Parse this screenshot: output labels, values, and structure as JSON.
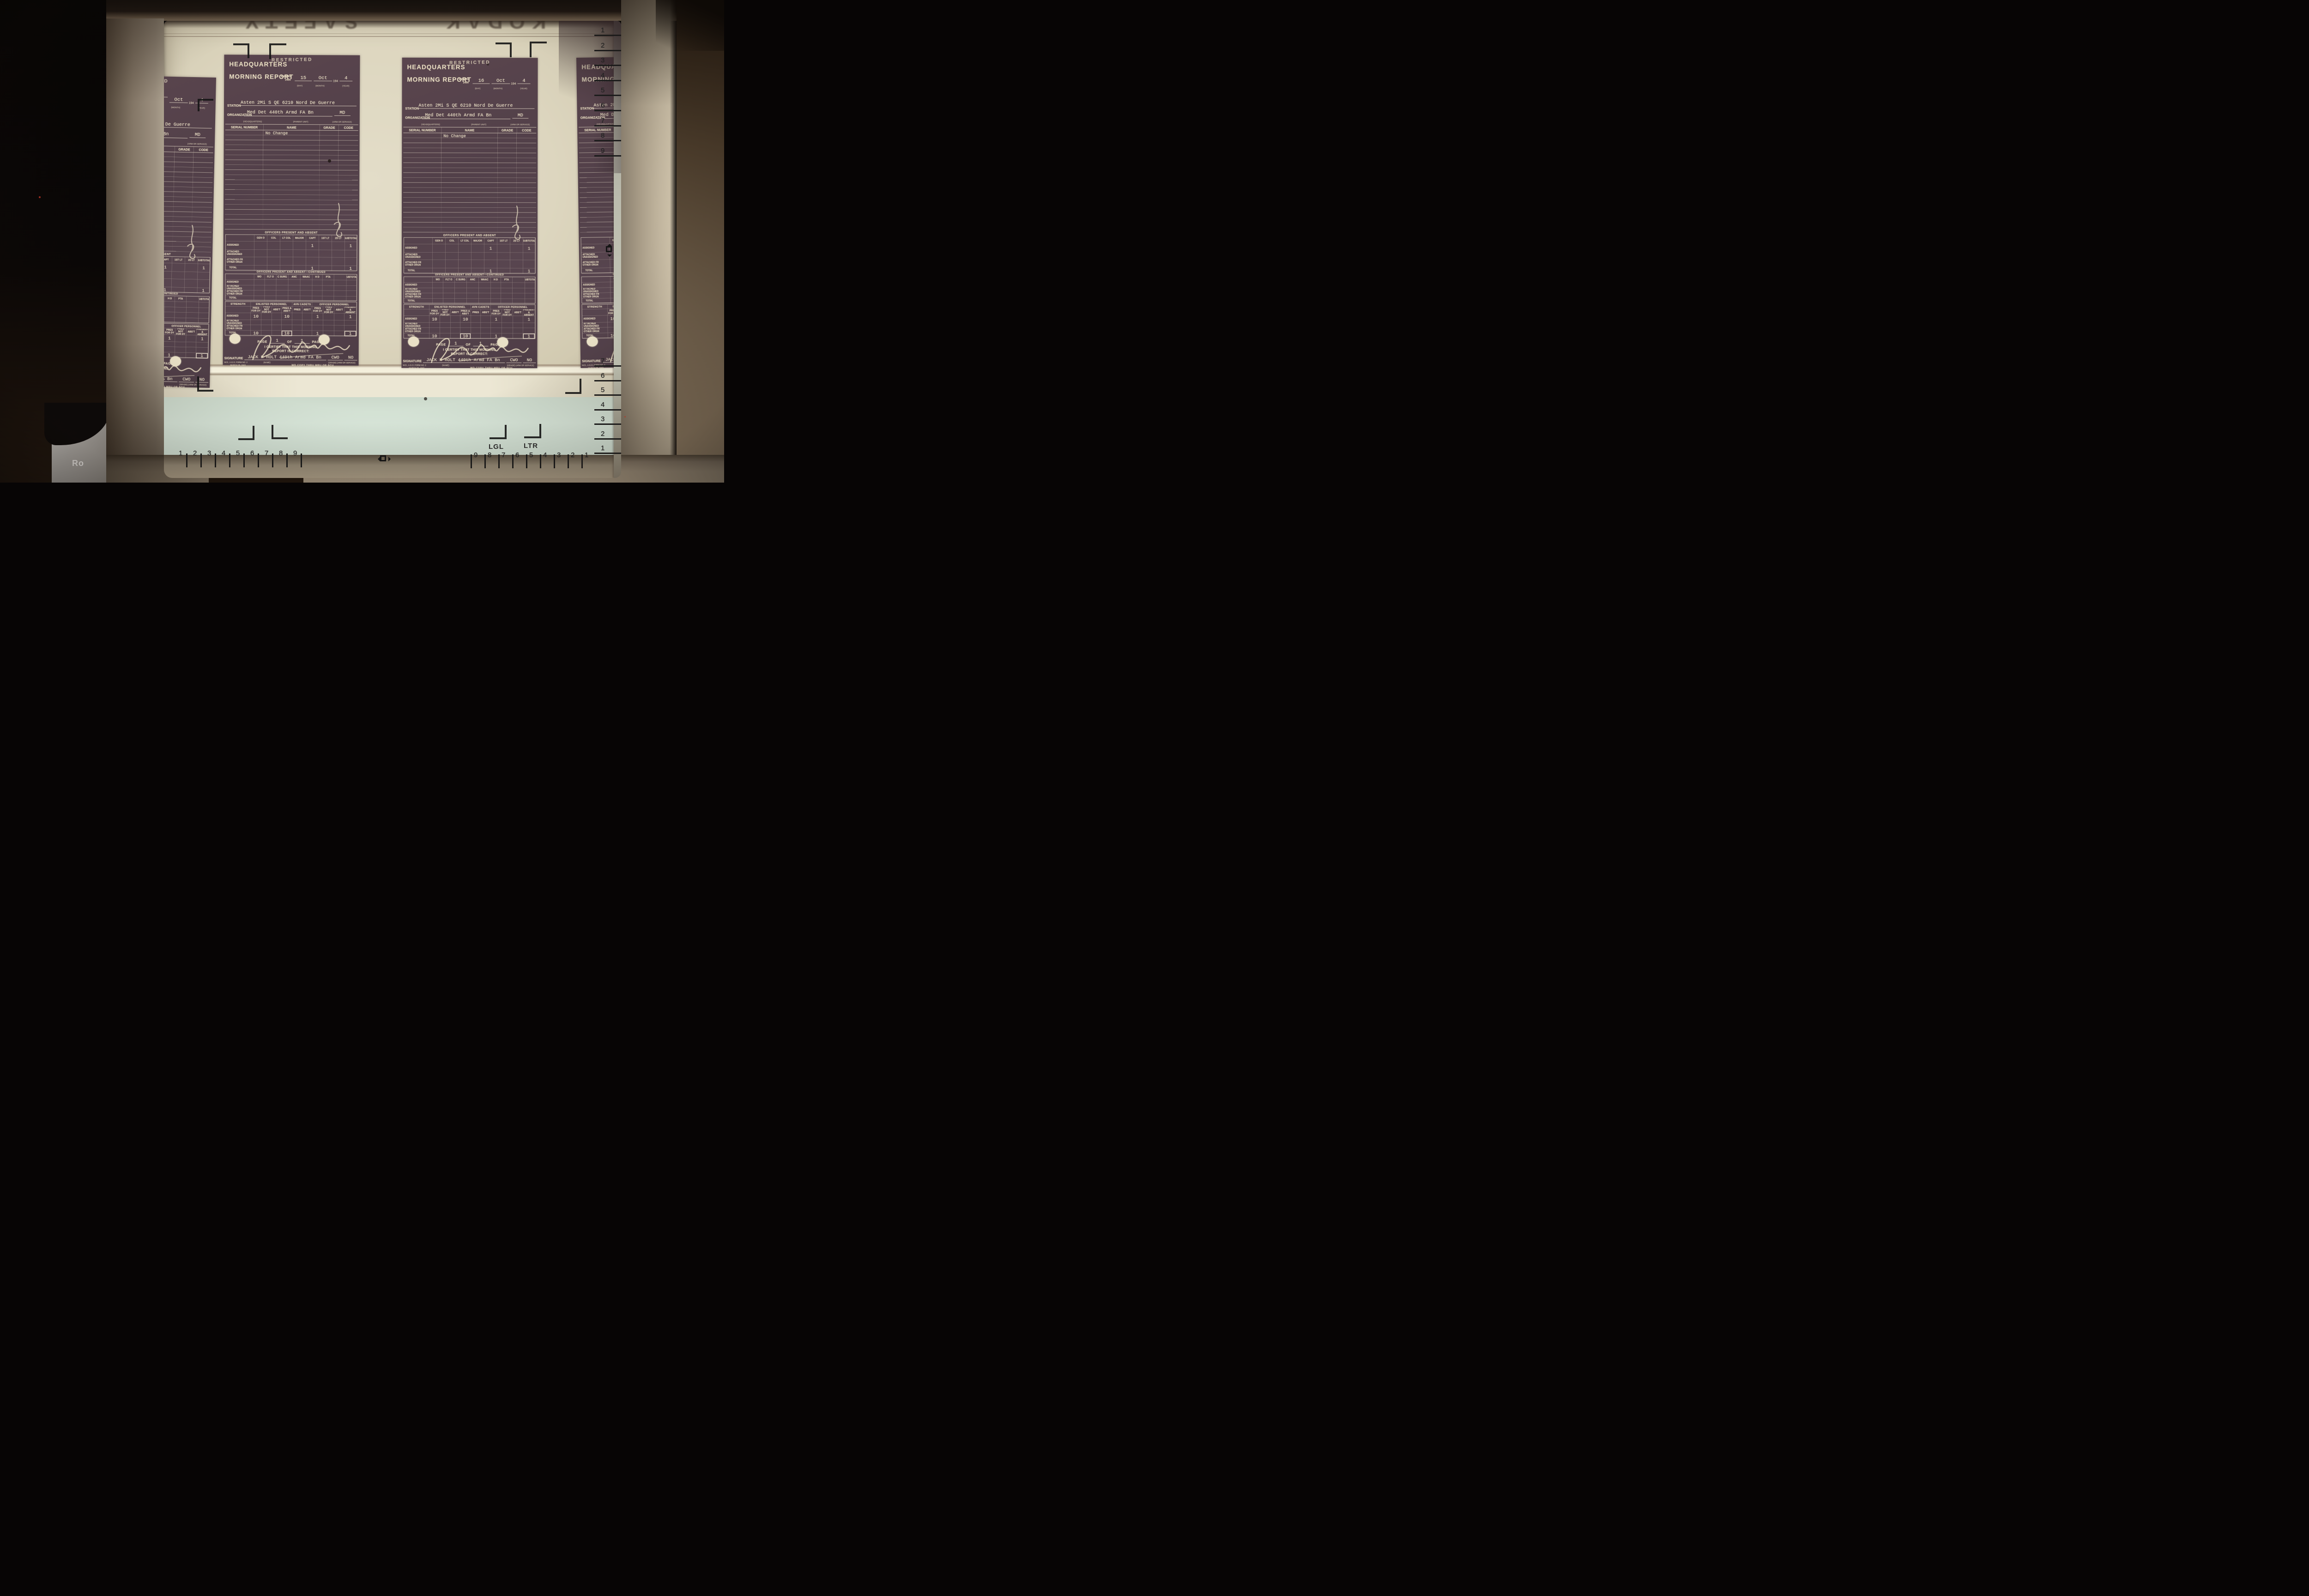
{
  "photo": {
    "device_brand_fragment": "Ro",
    "film_edge_text": "KODAK SAFETY"
  },
  "screen_controls": {
    "paper_size_left": "LGL",
    "paper_size_right": "LTR",
    "ruler_right_top": [
      "1",
      "2",
      "3",
      "4",
      "5",
      "6",
      "7",
      "8",
      "9"
    ],
    "ruler_right_bottom": [
      "7",
      "6",
      "5",
      "4",
      "3",
      "2",
      "1"
    ],
    "ruler_bottom_left": [
      "1",
      "2",
      "3",
      "4",
      "5",
      "6",
      "7",
      "8",
      "9"
    ],
    "ruler_bottom_right": [
      "9",
      "8",
      "7",
      "6",
      "5",
      "4",
      "3",
      "2",
      "1"
    ]
  },
  "form": {
    "classification": "RESTRICTED",
    "title_line1": "HEADQUARTERS",
    "title_line2": "MORNING REPORT",
    "ending_label": "ENDING",
    "ending_time": "2400",
    "month": "Oct",
    "year_prefix": "194",
    "year_suffix": "4",
    "sub_day": "(DAY)",
    "sub_month": "(MONTH)",
    "sub_year": "(YEAR)",
    "station_label": "STATION",
    "station_value": "Asten 2Mi S QE 6210 Nord De Guerre",
    "organization_label": "ORGANIZATION",
    "organization_value": "Med Det 440th Armd FA Bn",
    "arm_of_service": "MD",
    "sub_headquarters": "(HEADQUARTERS)",
    "sub_parent_unit": "(PARENT UNIT)",
    "sub_arm": "(ARM OR SERVICE)",
    "roster": {
      "h_serial": "SERIAL NUMBER",
      "h_name": "NAME",
      "h_grade": "GRADE",
      "h_code": "CODE",
      "entry": "No Change"
    },
    "officers": {
      "title": "OFFICERS PRESENT AND ABSENT",
      "cols": [
        "GEN O",
        "COL",
        "LT COL",
        "MAJOR",
        "CAPT",
        "1ST LT",
        "2D LT",
        "SUBTOTAL"
      ],
      "rows": [
        "ASSIGNED",
        "ATTACHED\nUNASSIGNED",
        "ATTACHED FR\nOTHER ORGN",
        "TOTAL"
      ],
      "assigned_capt": "1",
      "assigned_subtotal": "1",
      "total_capt": "1",
      "total_subtotal": "1"
    },
    "officers_cont": {
      "title": "OFFICERS PRESENT AND ABSENT—CONTINUED",
      "cols": [
        "WO",
        "FLT O",
        "C SURG",
        "ANC",
        "WAAC",
        "H D",
        "PTA",
        "",
        "SUBTOTAL"
      ]
    },
    "strength": {
      "label": "STRENGTH",
      "group_enlisted": "ENLISTED PERSONNEL",
      "group_avn": "AVN CADETS",
      "group_officer": "OFFICER PERSONNEL",
      "cols": [
        "PRES\nFOR DY",
        "PRES NOT\nFOR DY",
        "ABS'T",
        "PRES &\nABS'T",
        "PRES",
        "ABS'T",
        "PRES\nFOR DY",
        "PRES NOT\nFOR DY",
        "ABS'T",
        "PRESENT\n& ABSENT"
      ],
      "assigned": [
        "10",
        "",
        "",
        "10",
        "",
        "",
        "1",
        "",
        "",
        "1"
      ],
      "total": [
        "10",
        "",
        "",
        "10",
        "",
        "",
        "1",
        "",
        "",
        "1"
      ]
    },
    "page_label": "PAGE",
    "page_number": "1",
    "of_label": "OF",
    "pages_total": "1",
    "pages_label": "PAGES",
    "certify_text": "I CERTIFY THAT THIS MORNING\nREPORT IS CORRECT:",
    "signature_label": "SIGNATURE",
    "signature_handwritten": "Jack H Holt",
    "signature_name": "JACK H HOLT 440th Armd FA Bn",
    "signature_grade": "CWO",
    "signature_arm": "NO",
    "footer_form_no": "W.D., A.G.O. FORM NO. 2",
    "footer_form_date": "MARCH 25, 1943",
    "footer_name_sub": "(NAME)",
    "footer_grade_sub": "(GRADE)   (ARM OR SERVICE)",
    "footer_copy": "WD COPY THRU MRU OR SCU"
  },
  "forms": [
    {
      "ending_day": ""
    },
    {
      "ending_day": "15"
    },
    {
      "ending_day": "16"
    },
    {
      "ending_day": ""
    }
  ]
}
